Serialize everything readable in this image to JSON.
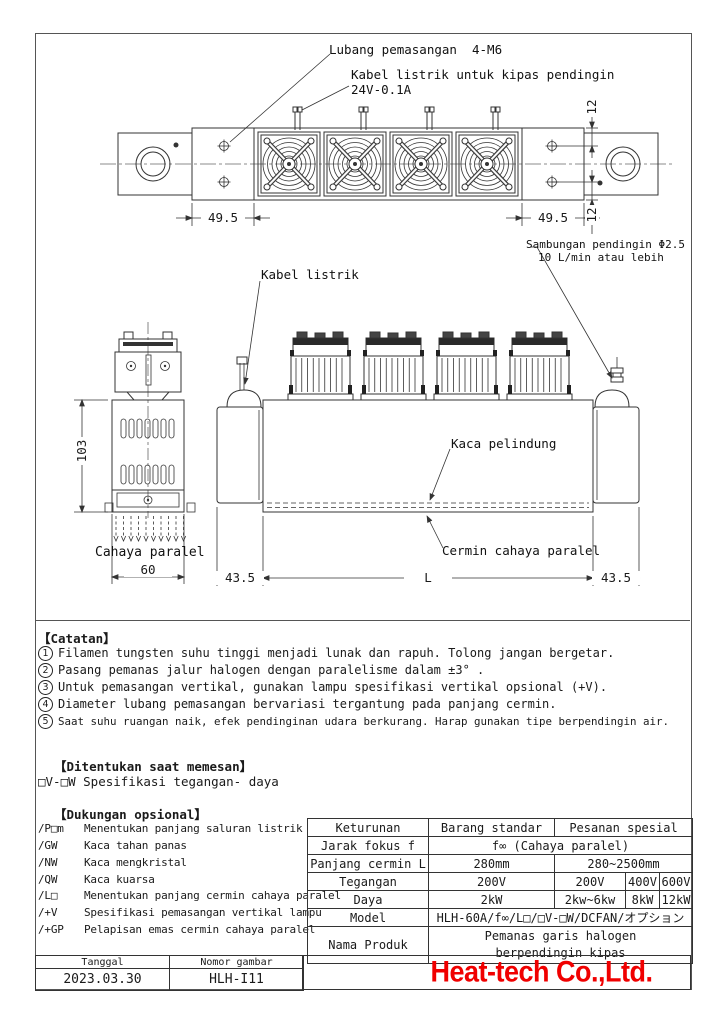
{
  "drawing": {
    "top_view": {
      "label_mounting_hole": "Lubang pemasangan  4-M6",
      "label_fan_cable_line1": "Kabel listrik untuk kipas pendingin",
      "label_fan_cable_line2": "24V-0.1A",
      "dim_end_left": "49.5",
      "dim_end_right": "49.5",
      "dim_offset_top": "12",
      "dim_offset_bottom": "12"
    },
    "front_view": {
      "label_power_cable": "Kabel listrik",
      "label_coolant_line1": "Sambungan pendingin Φ2.5",
      "label_coolant_line2": "10 L/min atau lebih",
      "label_protective_glass": "Kaca pelindung",
      "label_parallel_mirror": "Cermin cahaya paralel",
      "dim_left": "43.5",
      "dim_length": "L",
      "dim_right": "43.5"
    },
    "side_view": {
      "dim_height": "103",
      "label_parallel_light": "Cahaya paralel",
      "dim_width": "60"
    }
  },
  "notes": {
    "heading": "【Catatan】",
    "items": [
      {
        "num": "1",
        "text": "Filamen tungsten suhu tinggi menjadi lunak dan rapuh. Tolong jangan bergetar."
      },
      {
        "num": "2",
        "text": "Pasang pemanas jalur halogen dengan paralelisme dalam ±3° ."
      },
      {
        "num": "3",
        "text": "Untuk pemasangan vertikal, gunakan lampu spesifikasi vertikal opsional (+V)."
      },
      {
        "num": "4",
        "text": "Diameter lubang pemasangan bervariasi tergantung pada panjang cermin."
      },
      {
        "num": "5",
        "text": "Saat suhu ruangan naik, efek pendinginan udara berkurang. Harap gunakan tipe berpendingin air."
      }
    ]
  },
  "ordering": {
    "heading": "【Ditentukan saat memesan】",
    "item": "□V-□W Spesifikasi tegangan- daya"
  },
  "options": {
    "heading": "【Dukungan opsional】",
    "items": [
      {
        "code": "/P□m",
        "desc": "Menentukan panjang saluran listrik"
      },
      {
        "code": "/GW",
        "desc": "Kaca tahan panas"
      },
      {
        "code": "/NW",
        "desc": "Kaca mengkristal"
      },
      {
        "code": "/QW",
        "desc": "Kaca kuarsa"
      },
      {
        "code": "/L□",
        "desc": "Menentukan panjang cermin cahaya paralel"
      },
      {
        "code": "/+V",
        "desc": "Spesifikasi pemasangan vertikal lampu"
      },
      {
        "code": "/+GP",
        "desc": "Pelapisan emas cermin cahaya paralel"
      }
    ]
  },
  "spec_table": {
    "col_category": "Keturunan",
    "col_standard": "Barang standar",
    "col_special": "Pesanan spesial",
    "rows": {
      "focus_label": "Jarak fokus f",
      "focus_value": "f∞ (Cahaya paralel)",
      "mirror_label": "Panjang cermin L",
      "mirror_standard": "280mm",
      "mirror_special": "280~2500mm",
      "voltage_label": "Tegangan",
      "voltage_standard": "200V",
      "voltage_special_1": "200V",
      "voltage_special_2": "400V",
      "voltage_special_3": "600V",
      "power_label": "Daya",
      "power_standard": "2kW",
      "power_special_1": "2kw~6kw",
      "power_special_2": "8kW",
      "power_special_3": "12kW",
      "model_label": "Model",
      "model_value": "HLH-60A/f∞/L□/□V-□W/DCFAN/オプション",
      "product_label": "Nama Produk",
      "product_line1": "Pemanas garis halogen",
      "product_line2": "berpendingin kipas"
    }
  },
  "title_block": {
    "date_label": "Tanggal",
    "date_value": "2023.03.30",
    "number_label": "Nomor gambar",
    "number_value": "HLH-I11",
    "company": "Heat-tech Co.,Ltd."
  },
  "colors": {
    "logo_red": "#f00000",
    "line": "#333333"
  }
}
